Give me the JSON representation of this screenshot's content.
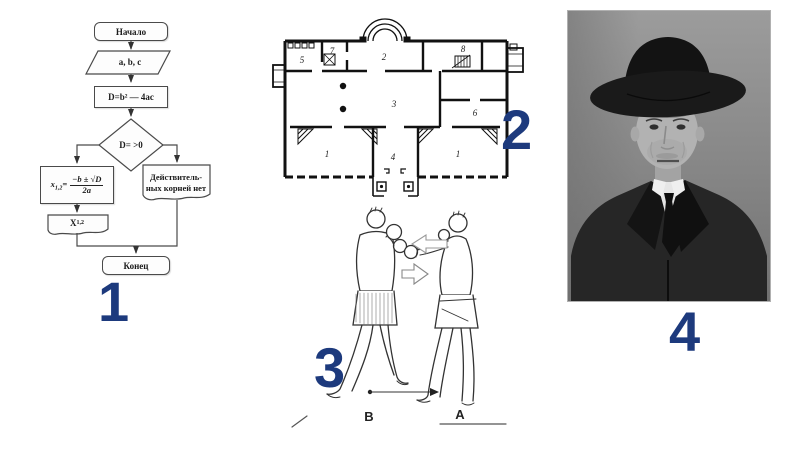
{
  "slide": {
    "background": "#ffffff",
    "number_color": "#1d3a7d"
  },
  "markers": {
    "m1": "1",
    "m2": "2",
    "m3": "3",
    "m4": "4"
  },
  "flowchart": {
    "start": "Начало",
    "input": "a, b, c",
    "process": "D=b² — 4ac",
    "decision": "D= >0",
    "formula": {
      "base": "x",
      "sub": "1,2",
      "eq": "=",
      "numerator": "−b ± √D",
      "denominator": "2a"
    },
    "no_roots_line1": "Действитель-",
    "no_roots_line2": "ных корней нет",
    "output": {
      "base": "X",
      "sub": "1,2"
    },
    "end": "Конец"
  },
  "floor_plan": {
    "rooms": {
      "r5": "5",
      "r7": "7",
      "r2": "2",
      "r8": "8",
      "r3": "3",
      "r6": "6",
      "r1a": "1",
      "r4": "4",
      "r1b": "1"
    }
  },
  "boxing": {
    "left_label": "B",
    "right_label": "A"
  }
}
